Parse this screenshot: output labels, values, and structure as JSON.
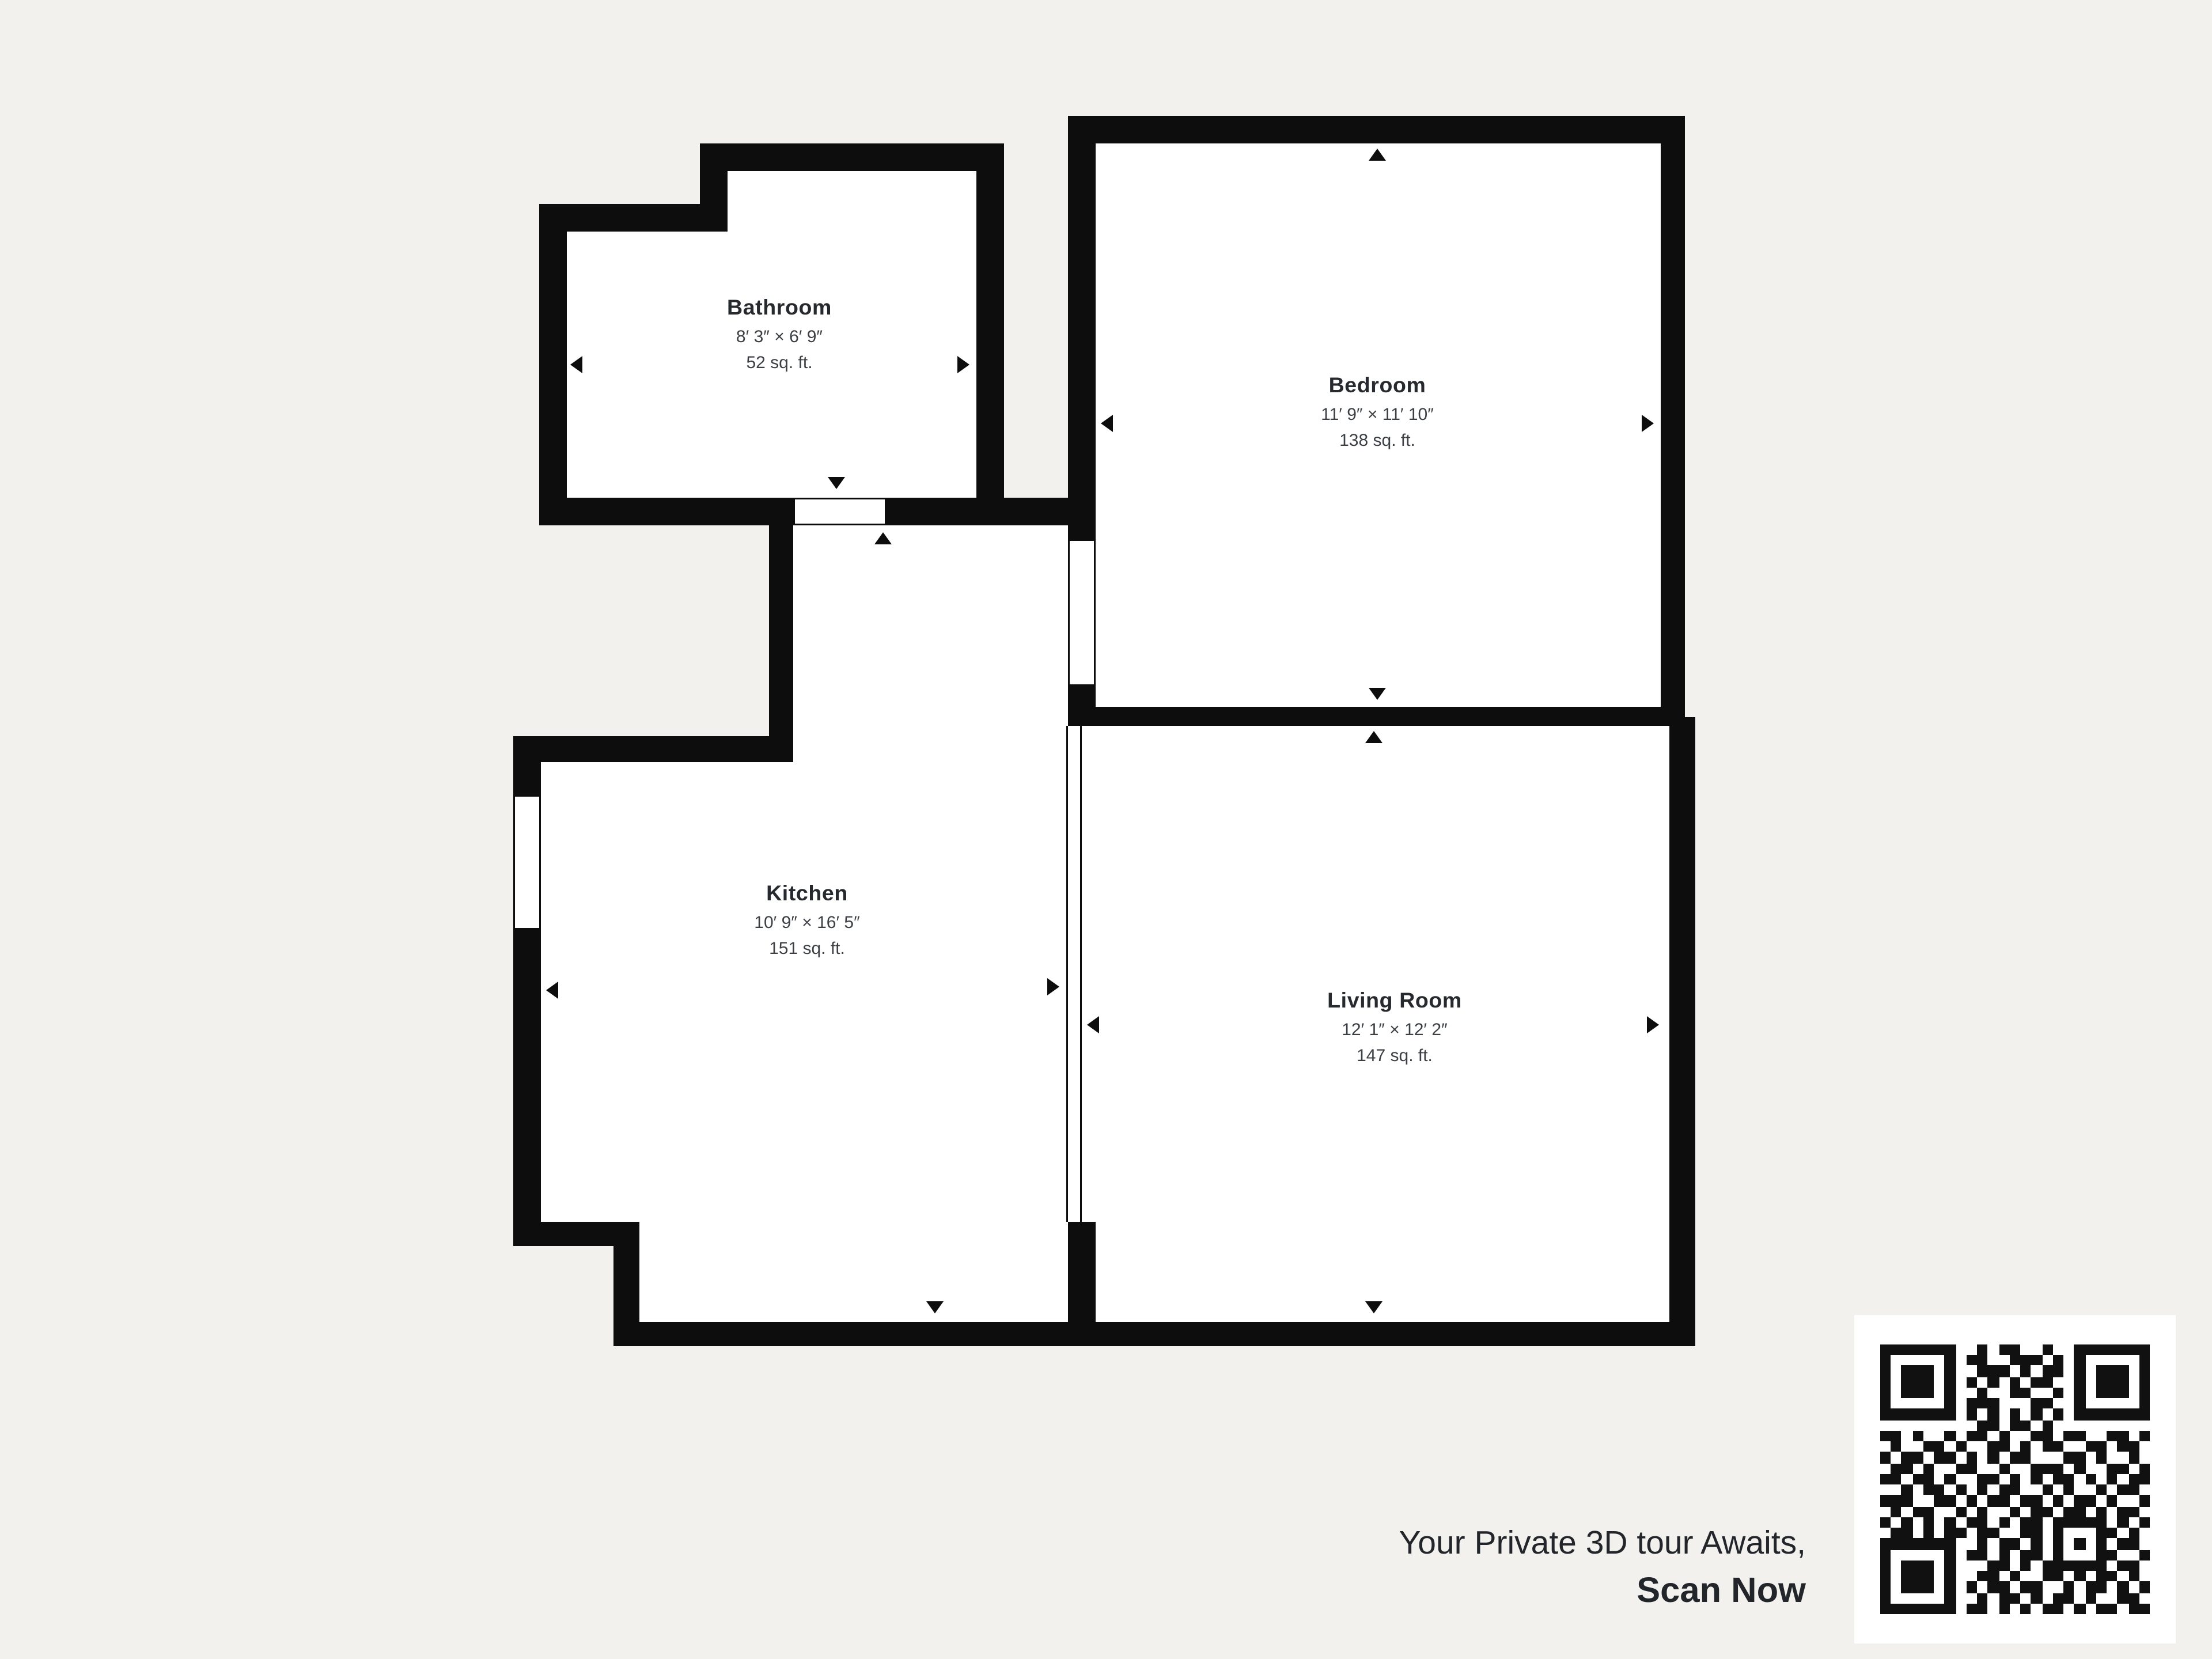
{
  "floorplan": {
    "rooms": [
      {
        "name": "Bathroom",
        "dimensions": "8′ 3″ × 6′ 9″",
        "area": "52 sq. ft."
      },
      {
        "name": "Bedroom",
        "dimensions": "11′ 9″ × 11′ 10″",
        "area": "138 sq. ft."
      },
      {
        "name": "Kitchen",
        "dimensions": "10′ 9″ × 16′ 5″",
        "area": "151 sq. ft."
      },
      {
        "name": "Living Room",
        "dimensions": "12′ 1″ × 12′ 2″",
        "area": "147 sq. ft."
      }
    ]
  },
  "cta": {
    "line1": "Your Private 3D tour Awaits,",
    "line2": "Scan Now"
  },
  "qr_code": {
    "size": 25,
    "modules": [
      "1111111001011001001111111",
      "1000001011001110101000001",
      "1011101001110101101011101",
      "1011101010101011001011101",
      "1011101001001100101011101",
      "1000001011100011001000001",
      "1111111010101010101111111",
      "0000000001101101000000000",
      "1101001011010011011001101",
      "0100110100110101100110110",
      "1011011010101100011010010",
      "0110100110010011101001101",
      "1101101001101010110101011",
      "0010110101011001010010110",
      "1110011010110110101101001",
      "0101100101001011011010110",
      "1010101011010110111110101",
      "0110101101100110100011010",
      "1111111001011010101010110",
      "1000001011010110100011001",
      "1011101000110101111110110",
      "1011101001101001101011010",
      "1011101010110110010110101",
      "1000001001011010110100110",
      "1111111011010101101011011"
    ]
  },
  "colors": {
    "background": "#f2f1ee",
    "wall": "#0d0d0d",
    "room": "#ffffff",
    "text_dark": "#26292d",
    "text_medium": "#3c4044",
    "cta_text": "#22252a",
    "qr_dark": "#111111",
    "qr_light": "#ffffff"
  }
}
